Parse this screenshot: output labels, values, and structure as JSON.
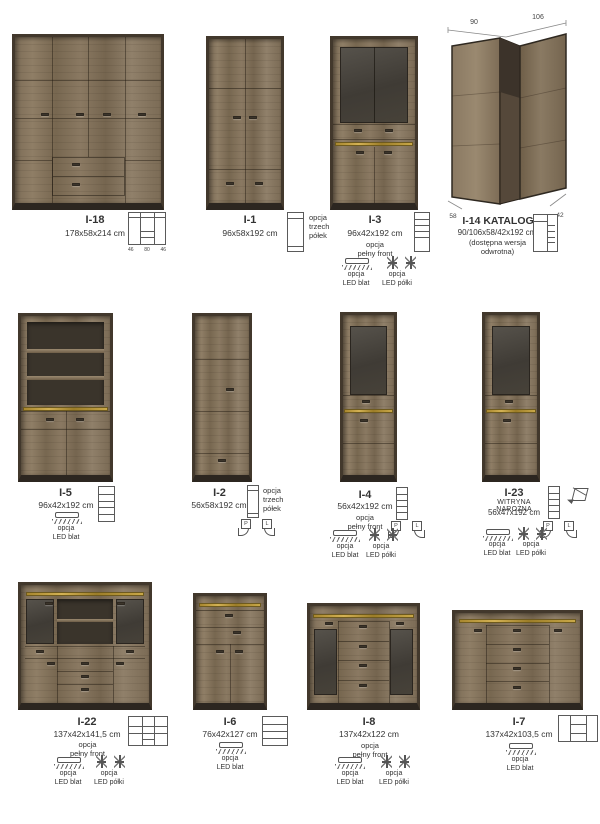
{
  "products": {
    "i18": {
      "name": "I-18",
      "dims": "178x58x214 cm",
      "feet": [
        "46",
        "80",
        "46"
      ]
    },
    "i1": {
      "name": "I-1",
      "dims": "96x58x192 cm",
      "option": "opcja\ntrzech\npółek"
    },
    "i3": {
      "name": "I-3",
      "dims": "96x42x192 cm",
      "option": "opcja\npełny front",
      "led_blat": "opcja\nLED blat",
      "led_polki": "opcja\nLED półki"
    },
    "i14": {
      "name": "I-14 KATALOG",
      "dims": "90/106x58/42x192 cm",
      "note": "(dostępna wersja\nodwrotna)",
      "dim_top_left": "90",
      "dim_top_right": "106",
      "dim_bottom_left": "58",
      "dim_bottom_right": "42"
    },
    "i5": {
      "name": "I-5",
      "dims": "96x42x192 cm",
      "led_blat": "opcja\nLED blat"
    },
    "i2": {
      "name": "I-2",
      "dims": "56x58x192 cm",
      "option": "opcja\ntrzech\npółek",
      "p": "P",
      "l": "L"
    },
    "i4": {
      "name": "I-4",
      "dims": "56x42x192 cm",
      "option": "opcja\npełny front",
      "p": "P",
      "l": "L",
      "led_blat": "opcja\nLED blat",
      "led_polki": "opcja\nLED półki"
    },
    "i23": {
      "name": "I-23",
      "subtitle": "WITRYNA NAROŻNA",
      "dims": "56x47x192 cm",
      "p": "P",
      "l": "L",
      "led_blat": "opcja\nLED blat",
      "led_polki": "opcja\nLED półki"
    },
    "i22": {
      "name": "I-22",
      "dims": "137x42x141,5 cm",
      "option": "opcja\npełny front",
      "led_blat": "opcja\nLED blat",
      "led_polki": "opcja\nLED półki"
    },
    "i6": {
      "name": "I-6",
      "dims": "76x42x127 cm",
      "led_blat": "opcja\nLED blat"
    },
    "i8": {
      "name": "I-8",
      "dims": "137x42x122 cm",
      "option": "opcja\npełny front",
      "led_blat": "opcja\nLED blat",
      "led_polki": "opcja\nLED półki"
    },
    "i7": {
      "name": "I-7",
      "dims": "137x42x103,5 cm",
      "led_blat": "opcja\nLED blat"
    }
  },
  "colors": {
    "wood": "#82715b",
    "frame": "#42382c",
    "gold": "#c9a848",
    "glass": "#45403a"
  }
}
